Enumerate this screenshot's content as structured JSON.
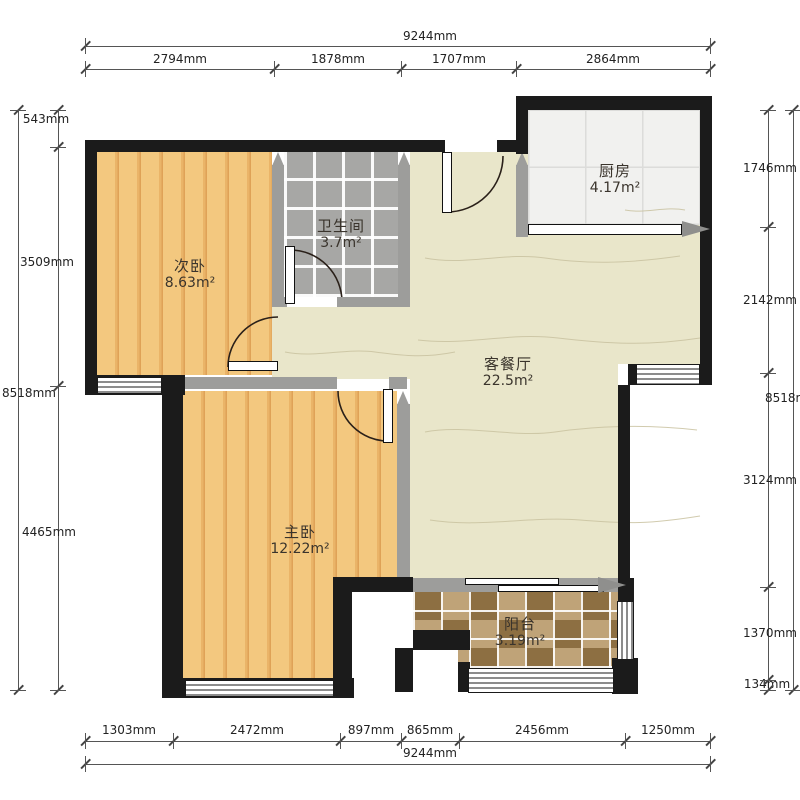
{
  "rooms": [
    {
      "id": "second-bedroom",
      "name": "次卧",
      "area": "8.63",
      "unit": "m²"
    },
    {
      "id": "bathroom",
      "name": "卫生间",
      "area": "3.7",
      "unit": "m²"
    },
    {
      "id": "kitchen",
      "name": "厨房",
      "area": "4.17",
      "unit": "m²"
    },
    {
      "id": "living-dining",
      "name": "客餐厅",
      "area": "22.5",
      "unit": "m²"
    },
    {
      "id": "master-bedroom",
      "name": "主卧",
      "area": "12.22",
      "unit": "m²"
    },
    {
      "id": "balcony",
      "name": "阳台",
      "area": "3.19",
      "unit": "m²"
    }
  ],
  "dimensions": {
    "top": {
      "total": "9244mm",
      "segments": [
        "2794mm",
        "1878mm",
        "1707mm",
        "2864mm"
      ]
    },
    "bottom": {
      "total": "9244mm",
      "segments": [
        "1303mm",
        "2472mm",
        "897mm",
        "865mm",
        "2456mm",
        "1250mm"
      ]
    },
    "left": {
      "total": "8518mm",
      "segments": [
        "543mm",
        "3509mm",
        "4465mm"
      ]
    },
    "right": {
      "total": "8518mm",
      "segments": [
        "1746mm",
        "2142mm",
        "3124mm",
        "1370mm",
        "134mm"
      ]
    }
  },
  "colors": {
    "exterior_wall": "#1b1b1b",
    "interior_wall": "#9d9d9b",
    "wood_floor": "#f3c87f",
    "bath_tile": "#a7a7a5",
    "kitchen_tile": "#f1f1ef",
    "living_floor": "#e9e6ca",
    "balcony_tile_light": "#bfa378",
    "balcony_tile_dark": "#8d6f42"
  }
}
